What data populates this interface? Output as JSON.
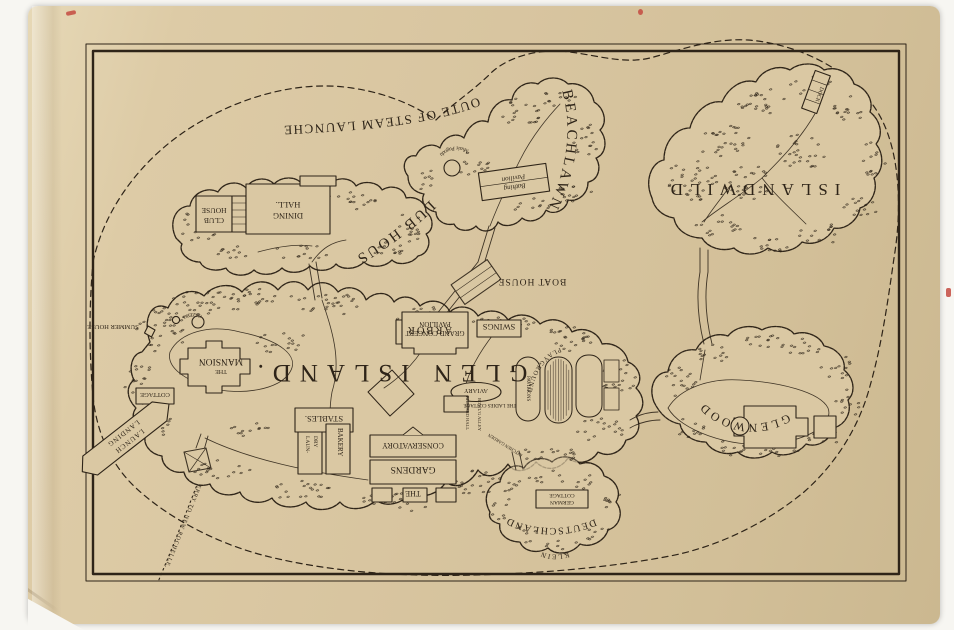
{
  "scene": {
    "background_color": "#f7f6f2",
    "paper_color": "#d8c5a0",
    "ink_color": "#2e2418",
    "accent_red": "#c44a41"
  },
  "route": {
    "steam_launches": "ROUTE OF STEAM LAUNCHES",
    "ferry": "FERRY TO NEW ROCHELLE."
  },
  "islands": {
    "glen_island": {
      "title": "GLEN ISLAND."
    },
    "club_house_island": {
      "title": "CLUB HOUSE"
    },
    "beachlawn": {
      "title": "BEACHLAWN"
    },
    "islandwild": {
      "title": "ISLANDWILD"
    },
    "glenwood": {
      "title": "GLENWOOD"
    },
    "klein_deutschland": {
      "title_line1": "KLEIN",
      "title_line2": "DEUTSCHLAND"
    }
  },
  "features": {
    "club_house": {
      "line1": "CLUB",
      "line2": "HOUSE"
    },
    "dining_hall": {
      "line1": "DINING",
      "line2": "HALL."
    },
    "bathing_pavilion": {
      "line1": "Bathing",
      "line2": "Pavilion"
    },
    "music_pagoda": {
      "label": "Music Pagoda"
    },
    "dock": {
      "label": "DOCK"
    },
    "boat_house": {
      "label": "BOAT HOUSE"
    },
    "grand_concert_pavilion": {
      "line1": "GRAND CONCERT",
      "line2": "PAVILION"
    },
    "swings": {
      "label": "SWINGS"
    },
    "arbor": {
      "label": "ARBOR"
    },
    "gazebo": {
      "label": "GAZEBO"
    },
    "mansion": {
      "line1": "THE",
      "line2": "MANSION"
    },
    "summer_house": {
      "label": "SUMMER HOUSE"
    },
    "cottage": {
      "label": "COTTAGE"
    },
    "aviary": {
      "label": "AVIARY"
    },
    "ladies_cottage": {
      "label": "THE LADIES COTTAGE"
    },
    "pavilions": {
      "label": "PAVILIONS"
    },
    "playground": {
      "label": "PLAYGROUND"
    },
    "stables": {
      "label": "STABLES."
    },
    "bakery": {
      "label": "BAKERY"
    },
    "laundry": {
      "line1": "LAUN-",
      "line2": "DRY"
    },
    "conservatory": {
      "label": "CONSERVATORY"
    },
    "gardens": {
      "line1": "THE",
      "line2": "GARDENS"
    },
    "billiard_hall": {
      "label": "BILLIARD HALL"
    },
    "bowling_alley": {
      "label": "BOWL'G ALLEY"
    },
    "kitchen_garden": {
      "label": "KITCHEN GARDEN"
    },
    "landing": {
      "line1": "LAUNCH",
      "line2": "LANDING"
    },
    "german_cottage": {
      "line1": "GERMAN",
      "line2": "COTTAGE"
    }
  }
}
